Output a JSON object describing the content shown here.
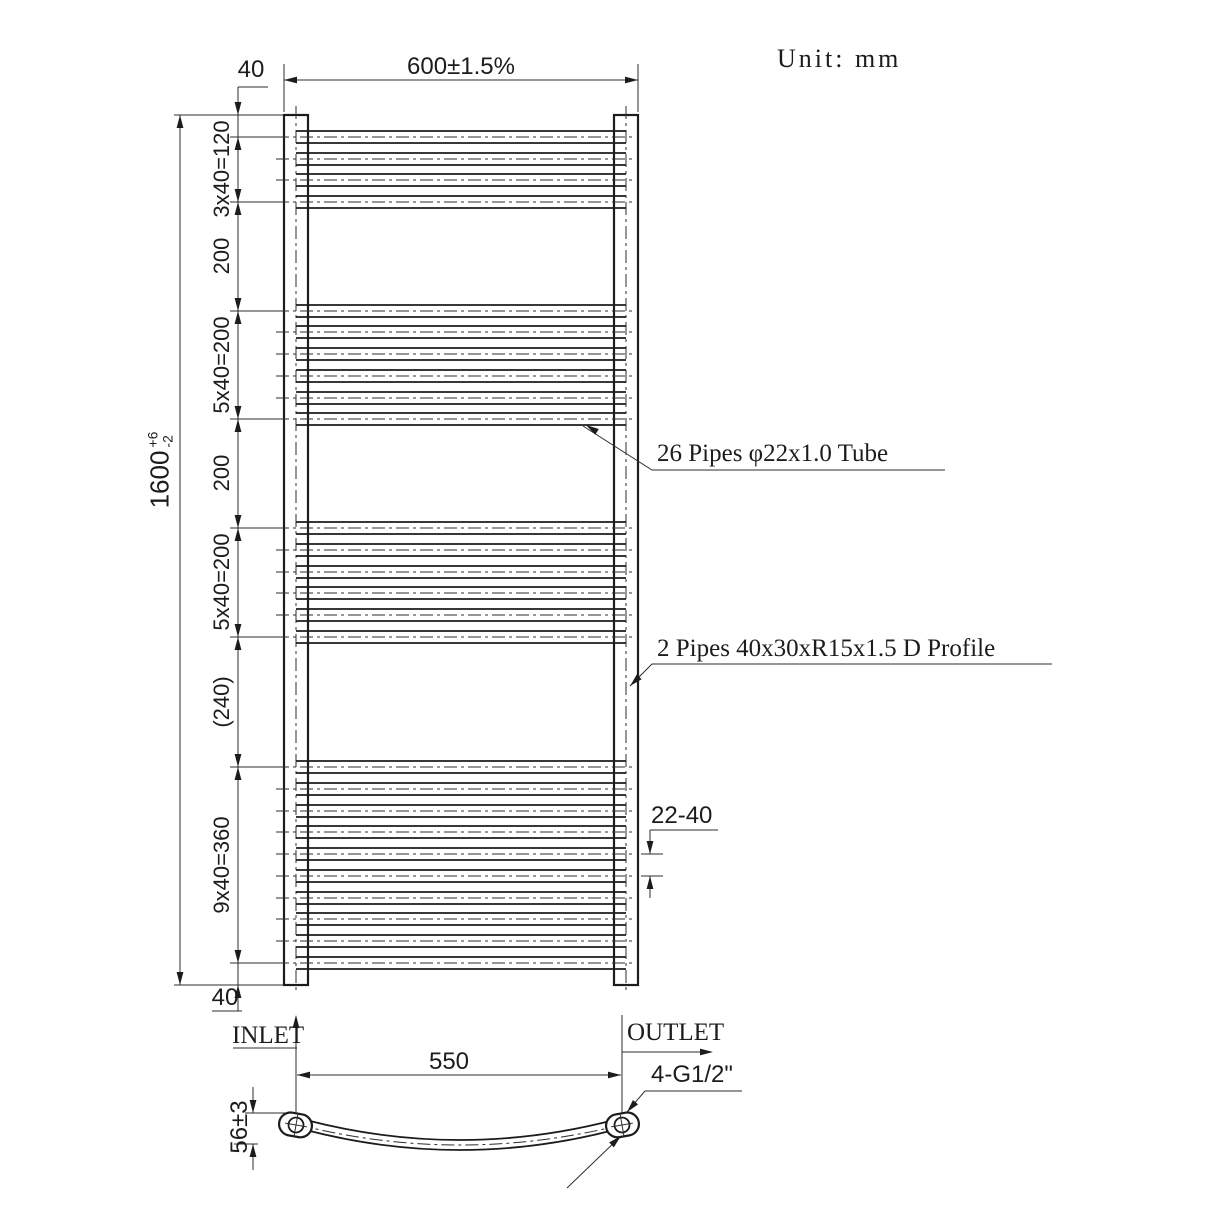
{
  "unit": "Unit: mm",
  "front_view": {
    "width_dim": "600±1.5%",
    "top_offset_dim": "40",
    "bottom_offset_dim": "40",
    "height_dim": {
      "value": "1600",
      "upper_tol": "+6",
      "lower_tol": "-2"
    },
    "segment_dims": [
      "3x40=120",
      "200",
      "5x40=200",
      "200",
      "5x40=200",
      "(240)",
      "9x40=360"
    ],
    "pipe_pitch_dim": "22-40",
    "tube_note": "26 Pipes φ22x1.0 Tube",
    "profile_note": "2 Pipes 40x30xR15x1.5 D Profile",
    "inlet_label": "INLET",
    "outlet_label": "OUTLET",
    "pipe_groups": [
      4,
      6,
      6,
      10
    ]
  },
  "bottom_view": {
    "centers_dim": "550",
    "bow_depth_dim": "56±3",
    "thread_note": "4-G1/2\""
  }
}
